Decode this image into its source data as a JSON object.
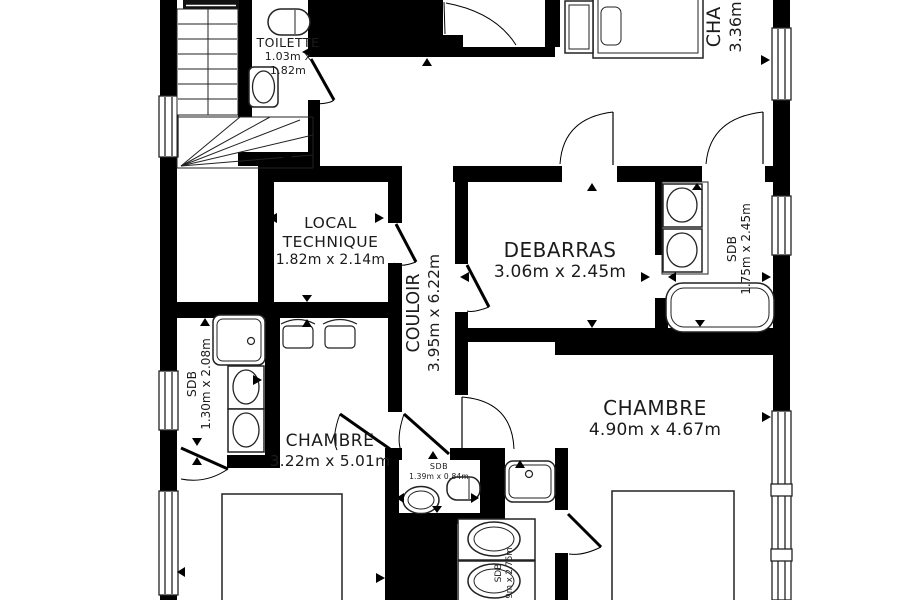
{
  "plan": {
    "colors": {
      "wall": "#000000",
      "line": "#222222",
      "text": "#1b1b1b",
      "background": "#ffffff"
    },
    "rooms": {
      "toilette": {
        "name": "TOILETTE",
        "dims_line1": "1.03m x",
        "dims_line2": "1.82m"
      },
      "local_technique": {
        "name_line1": "LOCAL",
        "name_line2": "TECHNIQUE",
        "dims": "1.82m x 2.14m"
      },
      "couloir": {
        "name": "COULOIR",
        "dims": "3.95m x 6.22m"
      },
      "debarras": {
        "name": "DEBARRAS",
        "dims": "3.06m x 2.45m"
      },
      "chambre_top": {
        "name": "CHA",
        "dims": "3.36m"
      },
      "sdb_right": {
        "name": "SDB",
        "dims": "1.75m x 2.45m"
      },
      "sdb_left": {
        "name": "SDB",
        "dims": "1.30m x 2.08m"
      },
      "sdb_small": {
        "name": "SDB",
        "dims": "1.39m x 0.84m"
      },
      "sdb_bottom": {
        "name": "SDB",
        "dims": "9m x 2.75m"
      },
      "chambre_left": {
        "name": "CHAMBRE",
        "dims": "3.22m x 5.01m"
      },
      "chambre_right": {
        "name": "CHAMBRE",
        "dims": "4.90m x 4.67m"
      }
    }
  }
}
